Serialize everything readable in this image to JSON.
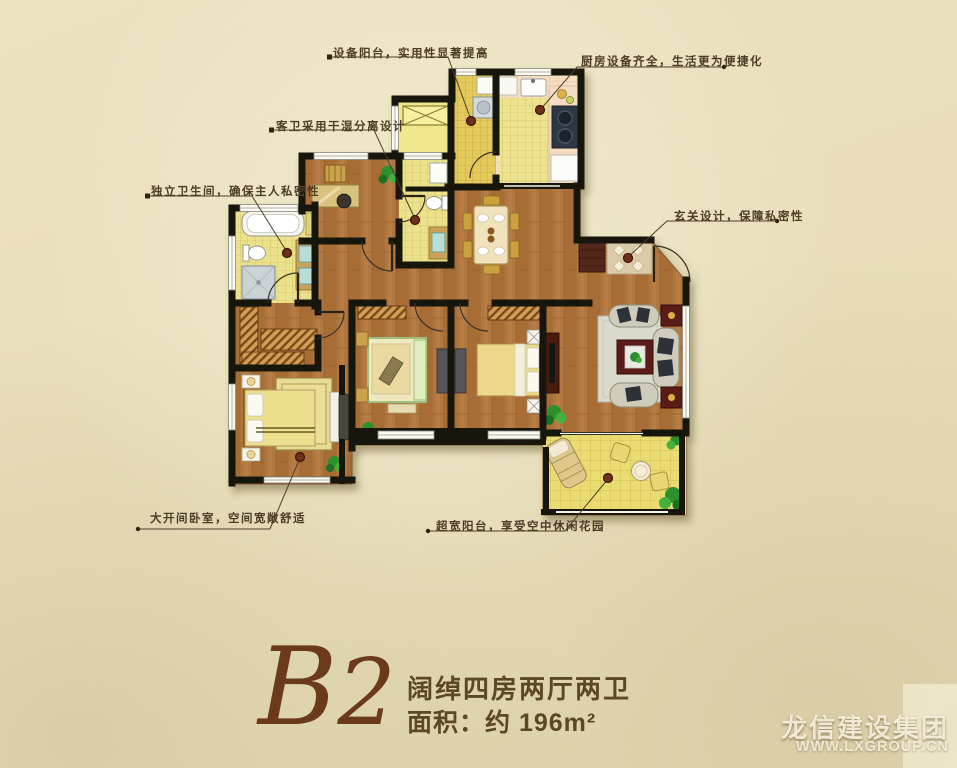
{
  "callouts": [
    {
      "id": "equipment-balcony",
      "text": "设备阳台，实用性显著提高"
    },
    {
      "id": "kitchen",
      "text": "厨房设备齐全，生活更为便捷化"
    },
    {
      "id": "guest-bath",
      "text": "客卫采用干湿分离设计"
    },
    {
      "id": "master-bath",
      "text": "独立卫生间，确保主人私密性"
    },
    {
      "id": "foyer",
      "text": "玄关设计，保障私密性"
    },
    {
      "id": "master-bedroom",
      "text": "大开间卧室，空间宽敞舒适"
    },
    {
      "id": "balcony",
      "text": "超宽阳台，享受空中休闲花园"
    }
  ],
  "plan": {
    "code_letter": "B",
    "code_digit": "2",
    "layout_desc": "阔绰四房两厅两卫",
    "area_text": "面积：约 196m²"
  },
  "watermark": {
    "company": "龙信建设集团",
    "website": "WWW.LXGROUP.CN"
  },
  "colors": {
    "background": "#e9e0bc",
    "wall": "#19190f",
    "wood": "#b1773f",
    "tile_pale": "#ece28c",
    "tile_orange": "#e4ca5c",
    "callout_text": "#4d3d25",
    "title_brown": "#6a3a1a"
  }
}
